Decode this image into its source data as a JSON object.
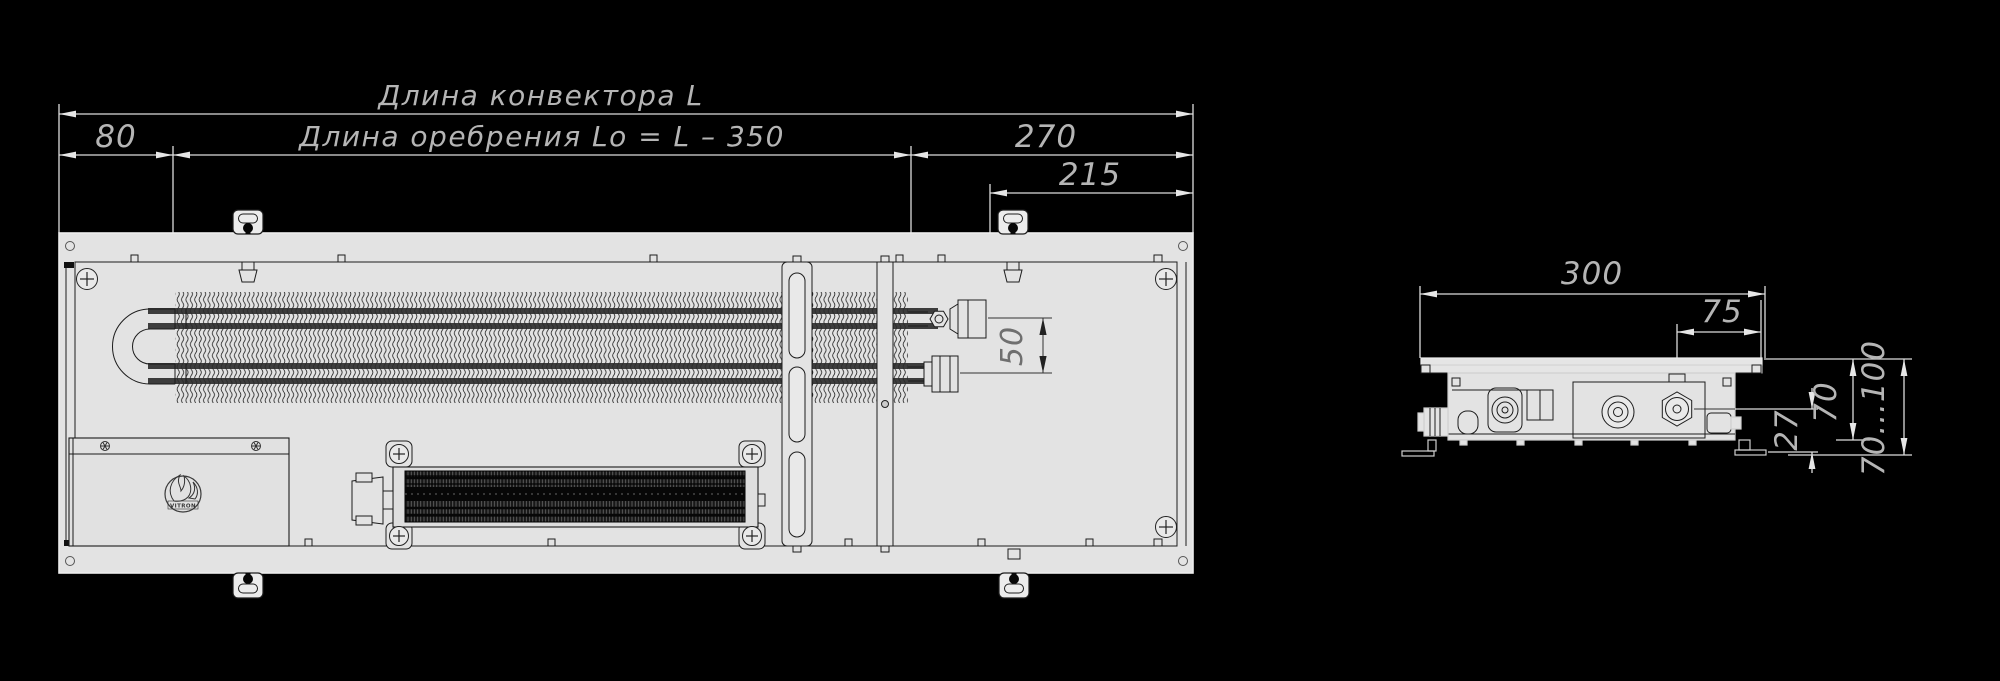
{
  "drawing": {
    "background": "#000000",
    "line_color": "#dcdcdc",
    "text_color": "#b5b5b5",
    "body_fill": "#e3e3e3",
    "detail_color": "#1c1c1c",
    "top_view": {
      "length_label": "Длина конвектора L",
      "finning_label": "Длина оребрения Lo = L – 350",
      "dim_left_offset": "80",
      "dim_right_offset": "270",
      "dim_connection_offset": "215",
      "dim_pipe_spacing": "50",
      "logo_text": "VITRON"
    },
    "side_view": {
      "dim_width": "300",
      "dim_connection": "75",
      "dim_pipe_height": "27",
      "dim_body_height": "70",
      "dim_install_depth": "70...100"
    }
  }
}
